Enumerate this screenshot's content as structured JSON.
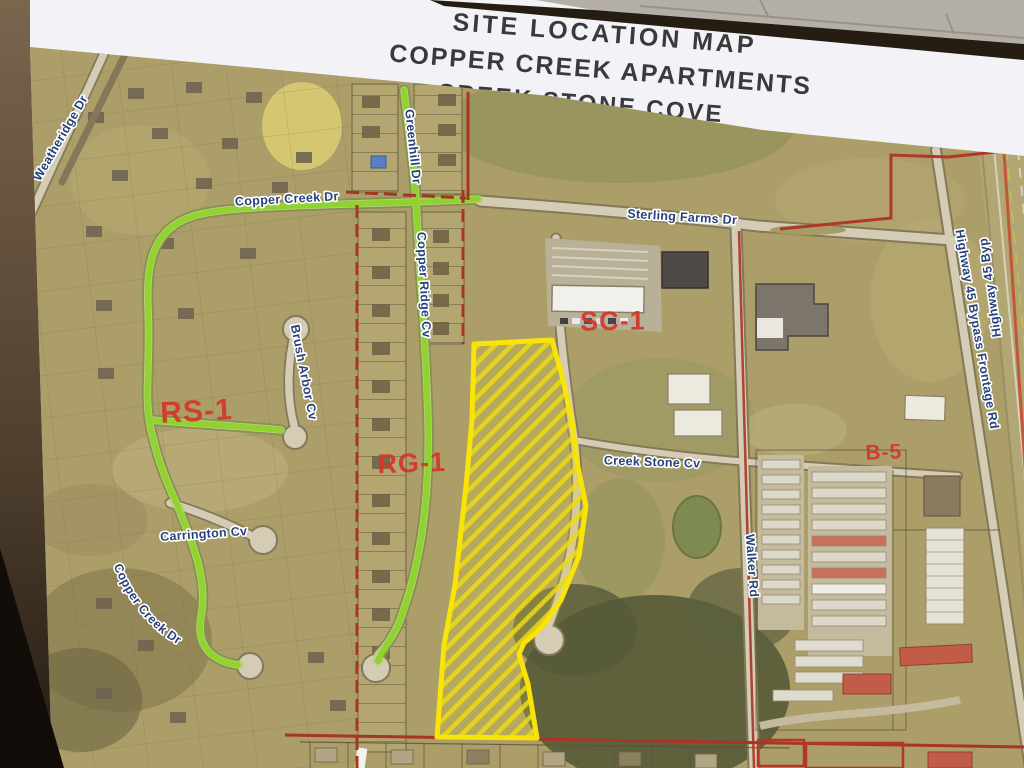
{
  "title": {
    "lines": [
      "SITE LOCATION MAP",
      "COPPER CREEK APARTMENTS",
      "CREEK STONE COVE"
    ]
  },
  "map": {
    "zones": [
      {
        "label": "RS-1"
      },
      {
        "label": "RG-1"
      },
      {
        "label": "SC-1"
      },
      {
        "label": "B-5"
      }
    ],
    "streets": [
      {
        "name": "Weatheridge Dr"
      },
      {
        "name": "Copper Creek Dr"
      },
      {
        "name": "Sterling Farms Dr"
      },
      {
        "name": "Greenhill Dr"
      },
      {
        "name": "Copper Ridge Cv"
      },
      {
        "name": "Brush Arbor Cv"
      },
      {
        "name": "Carrington Cv"
      },
      {
        "name": "Copper Creek Dr"
      },
      {
        "name": "Creek Stone Cv"
      },
      {
        "name": "Walker Rd"
      },
      {
        "name": "Highway 45 Bypass Frontage Rd"
      },
      {
        "name": "Highway 45 Byp"
      }
    ],
    "site_parcel": {
      "style": "diagonal-hatched",
      "outline_color": "#f8e408"
    },
    "colors": {
      "field": "#ab9e68",
      "road": "#d5ccb5",
      "highlight_road_green": "#8ed32a",
      "street_label_navy": "#27417a",
      "zone_label_red": "#d2372a",
      "boundary_red": "#a83424",
      "parcel_yellow": "#f8e408"
    }
  }
}
